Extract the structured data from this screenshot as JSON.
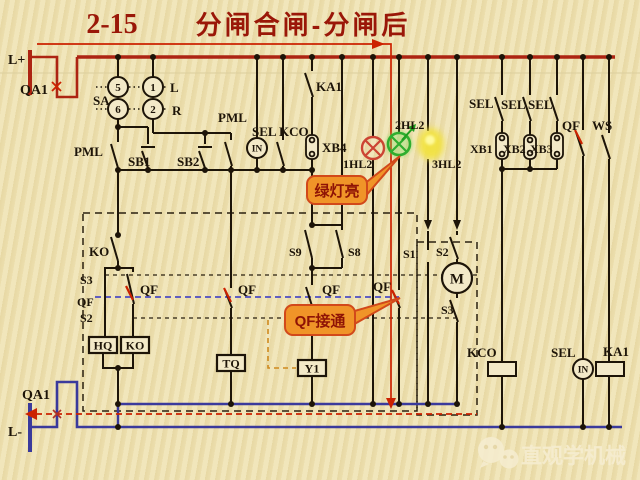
{
  "title": {
    "number": "2-15",
    "text": "分闸合闸-分闸后"
  },
  "colors": {
    "background": "#eee2b4",
    "wire": "#1d1408",
    "positive_bus": "#ad2412",
    "negative_rail": "#3a3a9c",
    "highlight_path": "#cc2200",
    "linkage_dashed": "#4d4dc4",
    "aux_dashed": "#cf8a1e",
    "callout_fill": "#f09428",
    "callout_border": "#d2491a",
    "callout_text": "#8f1305",
    "lamp_red": "#cc4433",
    "lamp_green": "#2fae2f",
    "lamp_yellow": "#f2e23a"
  },
  "sa": {
    "c5": "5",
    "c1": "1",
    "c6": "6",
    "c2": "2"
  },
  "components": {
    "in_top": "IN",
    "in_bottom": "IN",
    "motor": "M",
    "hq": "HQ",
    "ko": "KO",
    "tq": "TQ",
    "y1": "Y1"
  },
  "callouts": {
    "green_lamp": "绿灯亮",
    "qf_closed": "QF接通"
  },
  "watermark": {
    "text": "直观学机械"
  },
  "labels": [
    {
      "id": "l-plus",
      "text": "L+",
      "x": 8,
      "y": 64,
      "size": 14
    },
    {
      "id": "qa1-top",
      "text": "QA1",
      "x": 20,
      "y": 94,
      "size": 14
    },
    {
      "id": "sa",
      "text": "SA",
      "x": 93,
      "y": 105,
      "size": 13
    },
    {
      "id": "sa-l",
      "text": "L",
      "x": 170,
      "y": 92,
      "size": 13
    },
    {
      "id": "sa-r",
      "text": "R",
      "x": 172,
      "y": 115,
      "size": 13
    },
    {
      "id": "pml-left",
      "text": "PML",
      "x": 74,
      "y": 156,
      "size": 13
    },
    {
      "id": "sb1",
      "text": "SB1",
      "x": 128,
      "y": 166,
      "size": 13
    },
    {
      "id": "sb2",
      "text": "SB2",
      "x": 177,
      "y": 166,
      "size": 13
    },
    {
      "id": "pml-mid",
      "text": "PML",
      "x": 218,
      "y": 122,
      "size": 13
    },
    {
      "id": "ka1-top",
      "text": "KA1",
      "x": 316,
      "y": 91,
      "size": 13
    },
    {
      "id": "sel-top",
      "text": "SEL",
      "x": 252,
      "y": 136,
      "size": 13
    },
    {
      "id": "kco-top",
      "text": "KCO",
      "x": 279,
      "y": 136,
      "size": 13
    },
    {
      "id": "xb4",
      "text": "XB4",
      "x": 322,
      "y": 152,
      "size": 13
    },
    {
      "id": "hl1",
      "text": "1HL2",
      "x": 343,
      "y": 168,
      "size": 12
    },
    {
      "id": "hl2",
      "text": "2HL2",
      "x": 395,
      "y": 129,
      "size": 12
    },
    {
      "id": "hl3",
      "text": "3HL2",
      "x": 432,
      "y": 168,
      "size": 12
    },
    {
      "id": "sel-r1",
      "text": "SEL",
      "x": 469,
      "y": 108,
      "size": 13
    },
    {
      "id": "sel-r2",
      "text": "SEL",
      "x": 501,
      "y": 109,
      "size": 13
    },
    {
      "id": "sel-r3",
      "text": "SEL",
      "x": 528,
      "y": 109,
      "size": 13
    },
    {
      "id": "xb1",
      "text": "XB1",
      "x": 470,
      "y": 153,
      "size": 12
    },
    {
      "id": "xb2",
      "text": "XB2",
      "x": 503,
      "y": 153,
      "size": 12
    },
    {
      "id": "xb3",
      "text": "XB3",
      "x": 530,
      "y": 153,
      "size": 12
    },
    {
      "id": "qf-main",
      "text": "QF",
      "x": 562,
      "y": 130,
      "size": 13
    },
    {
      "id": "ws",
      "text": "WS",
      "x": 592,
      "y": 130,
      "size": 13
    },
    {
      "id": "ko-sw",
      "text": "KO",
      "x": 89,
      "y": 256,
      "size": 13
    },
    {
      "id": "s3-left",
      "text": "S3",
      "x": 80,
      "y": 284,
      "size": 12
    },
    {
      "id": "qf-left",
      "text": "QF",
      "x": 77,
      "y": 306,
      "size": 12
    },
    {
      "id": "s2-left",
      "text": "S2",
      "x": 80,
      "y": 322,
      "size": 12
    },
    {
      "id": "qf-a",
      "text": "QF",
      "x": 140,
      "y": 294,
      "size": 13
    },
    {
      "id": "qf-b",
      "text": "QF",
      "x": 238,
      "y": 294,
      "size": 13
    },
    {
      "id": "qf-c",
      "text": "QF",
      "x": 322,
      "y": 294,
      "size": 13
    },
    {
      "id": "qf-d",
      "text": "QF",
      "x": 373,
      "y": 291,
      "size": 13
    },
    {
      "id": "s9",
      "text": "S9",
      "x": 289,
      "y": 256,
      "size": 12
    },
    {
      "id": "s8",
      "text": "S8",
      "x": 348,
      "y": 256,
      "size": 12
    },
    {
      "id": "s1",
      "text": "S1",
      "x": 403,
      "y": 258,
      "size": 12
    },
    {
      "id": "s2-right",
      "text": "S2",
      "x": 436,
      "y": 256,
      "size": 12
    },
    {
      "id": "s3-right",
      "text": "S3",
      "x": 441,
      "y": 314,
      "size": 12
    },
    {
      "id": "kco-bottom",
      "text": "KCO",
      "x": 467,
      "y": 357,
      "size": 13
    },
    {
      "id": "sel-bottom",
      "text": "SEL",
      "x": 551,
      "y": 357,
      "size": 13
    },
    {
      "id": "ka1-bottom",
      "text": "KA1",
      "x": 603,
      "y": 356,
      "size": 13
    },
    {
      "id": "qa1-bottom",
      "text": "QA1",
      "x": 22,
      "y": 399,
      "size": 14
    },
    {
      "id": "l-minus",
      "text": "L-",
      "x": 8,
      "y": 436,
      "size": 14
    }
  ]
}
